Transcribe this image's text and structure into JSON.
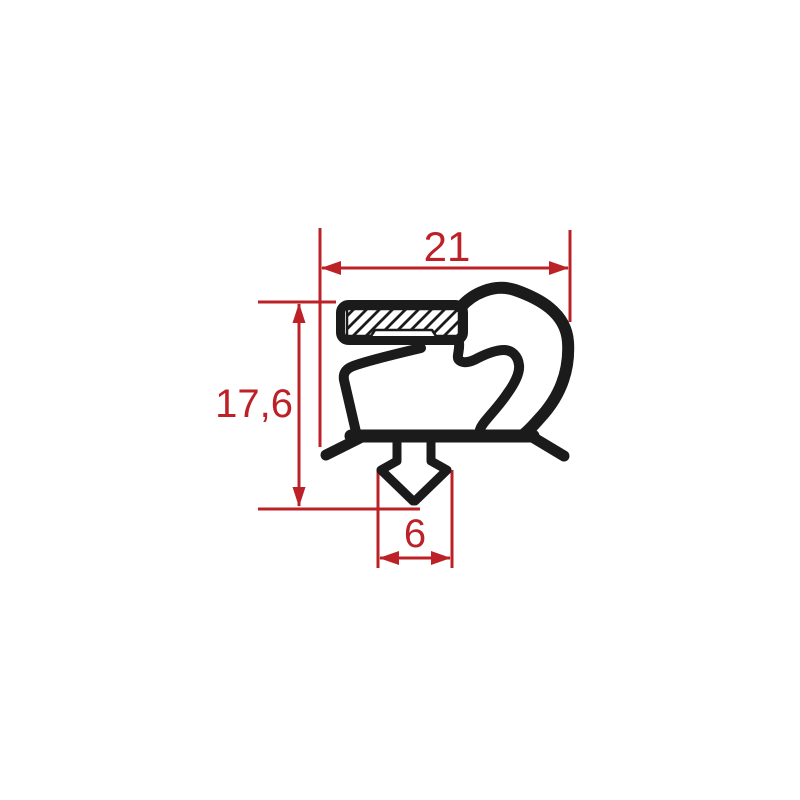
{
  "drawing": {
    "title": "gasket profile cross-section with dimensions",
    "background_color": "#ffffff",
    "line_color": "#1b1b1b",
    "dimension_color": "#bc2127",
    "dimensions": {
      "overall_width": {
        "label": "21",
        "value": 21,
        "orientation": "horizontal",
        "location": "top"
      },
      "overall_height": {
        "label": "17,6",
        "value": 17.6,
        "orientation": "vertical",
        "location": "left"
      },
      "dart_width": {
        "label": "6",
        "value": 6,
        "orientation": "horizontal",
        "location": "bottom"
      }
    }
  }
}
